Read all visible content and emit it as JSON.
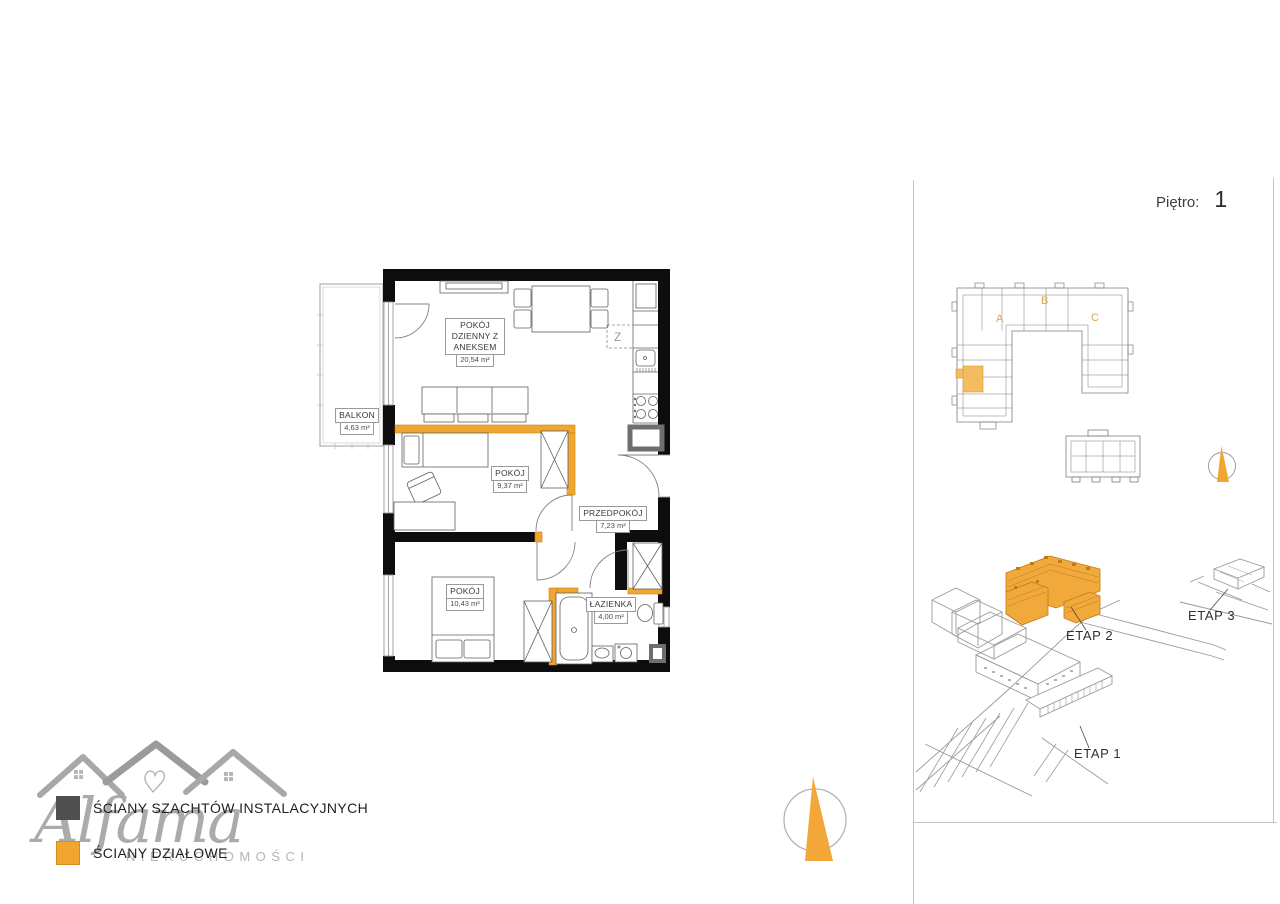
{
  "floor": {
    "label": "Piętro:",
    "value": "1"
  },
  "rooms": [
    {
      "name": "POKÓJ DZIENNY Z ANEKSEM",
      "area": "20,54 m²"
    },
    {
      "name": "BALKON",
      "area": "4,63 m²"
    },
    {
      "name": "POKÓJ",
      "area": "9,37 m²"
    },
    {
      "name": "PRZEDPOKÓJ",
      "area": "7,23 m²"
    },
    {
      "name": "POKÓJ",
      "area": "10,43 m²"
    },
    {
      "name": "ŁAZIENKA",
      "area": "4,00 m²"
    }
  ],
  "legend": {
    "items": [
      {
        "label": "ŚCIANY SZACHTÓW INSTALACYJNYCH",
        "color": "#4f4f4f"
      },
      {
        "label": "ŚCIANY DZIAŁOWE",
        "color": "#F0A62F"
      }
    ]
  },
  "logo": {
    "name": "Alfama",
    "subtitle": "NIERUCHOMOŚCI"
  },
  "key_plan": {
    "sections": [
      "A",
      "B",
      "C"
    ]
  },
  "site_plan": {
    "stages": [
      "ETAP 1",
      "ETAP 2",
      "ETAP 3"
    ]
  },
  "kitchen": {
    "appliance_mark": "Z"
  },
  "colors": {
    "accent": "#F0A62F",
    "wall_black": "#0d0d0d",
    "shaft_gray": "#6e6e6e",
    "highlight_unit": "#F3BC60"
  }
}
